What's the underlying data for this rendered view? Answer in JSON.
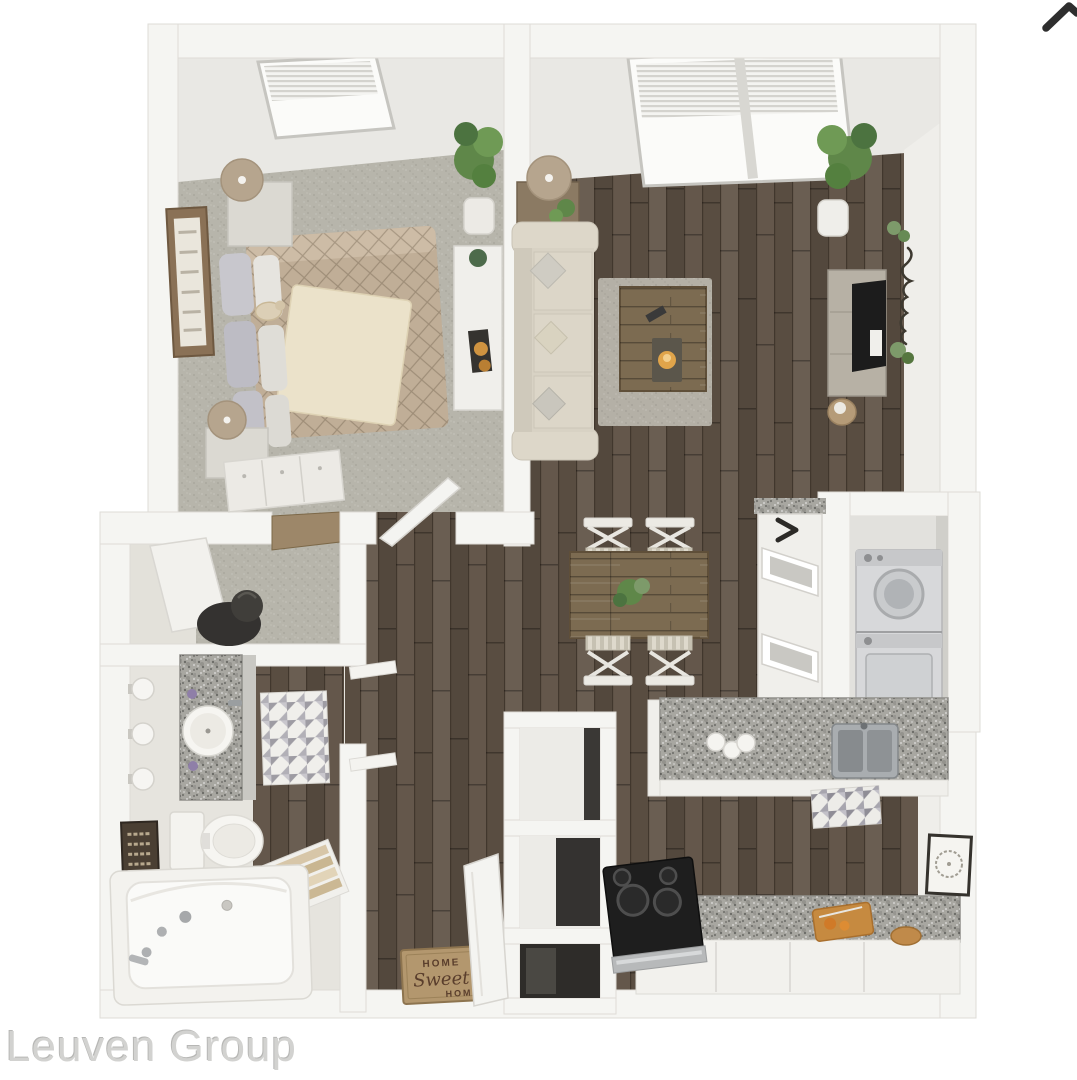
{
  "watermark": {
    "text": "Leuven Group"
  },
  "carousel": {
    "next_icon": "chevron-right"
  },
  "doormat": {
    "line1": "HOME",
    "line2": "Sweet",
    "line3": "HOME"
  },
  "palette": {
    "background": "#ffffff",
    "wall": "#f5f5f2",
    "wall_face": "#e9e8e4",
    "carpet": "#b7b5ab",
    "closet_floor": "#e3e1da",
    "tile": "#e6e4de",
    "wood": "#5f5245",
    "table_wood": "#7c6b51",
    "granite": "#a8a7a1",
    "sofa": "#d8d2c4",
    "comforter": "#c0ae97",
    "blanket": "#ebe2ca",
    "rug": "#b4b0a6",
    "mat": "#b3976e",
    "mat_text": "#5a3e2c",
    "plant": "#5f8749",
    "tv": "#1c1c1c",
    "stove": "#1e1e1e",
    "appliance": "#d7d8da",
    "watermark_color": "#d2d2d0",
    "arrow": "#2e2e2e"
  }
}
